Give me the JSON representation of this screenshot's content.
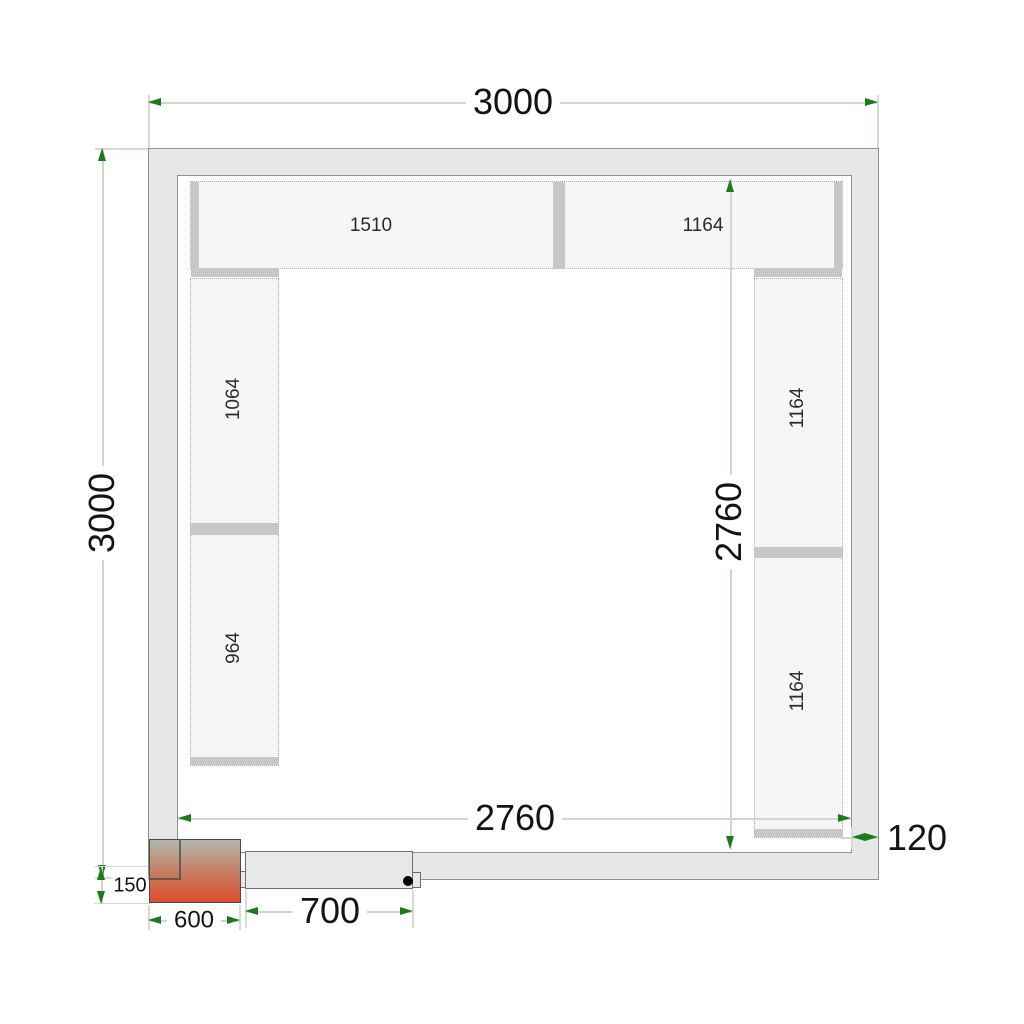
{
  "drawing": {
    "title": "cold-room floor plan with shelving",
    "dimensions": {
      "overall_width": "3000",
      "overall_depth": "3000",
      "inner_width": "2760",
      "inner_depth": "2760",
      "wall_thickness": "120",
      "door_opening": "700",
      "unit_width": "600",
      "unit_offset": "150"
    },
    "shelves": {
      "top_left": "1510",
      "top_right": "1164",
      "left_upper": "1064",
      "left_lower": "964",
      "right_upper": "1164",
      "right_lower": "1164"
    },
    "colors": {
      "dimension_arrow": "#1b7a1b",
      "dimension_line": "#ccd9cc",
      "wall_fill": "#e7e7e7",
      "wall_stroke": "#8f8f8f",
      "shelf_fill": "#f6f6f6",
      "shelf_border": "#a9a9a9",
      "support_bar": "#c7c7c7",
      "unit_gradient_top": "#b2b8af",
      "unit_gradient_bottom": "#dc4f2d",
      "door_fill": "#e8e8e8",
      "door_handle": "#000000"
    }
  }
}
